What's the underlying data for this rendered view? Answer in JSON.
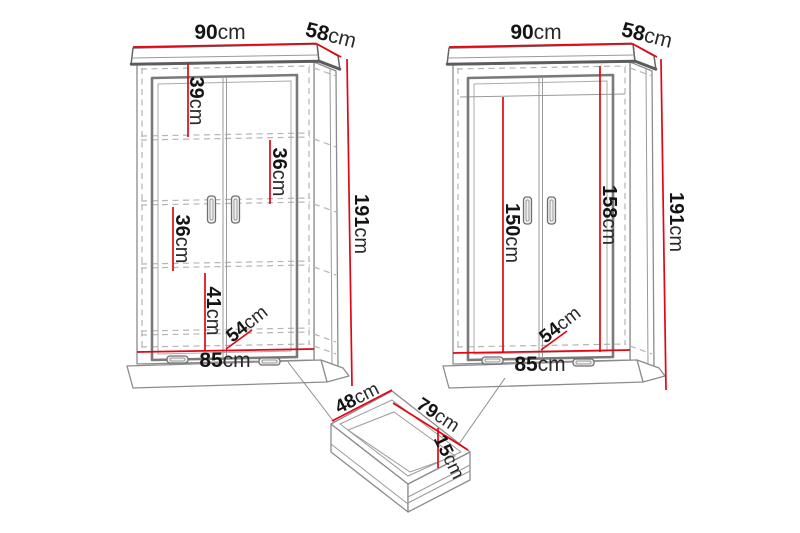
{
  "colors": {
    "dimension_line": "#e30613",
    "outline": "#8c8c8c",
    "outline_dark": "#5c5c5c",
    "dashed_line": "#b5b5b5",
    "label_text": "#141414",
    "background": "#ffffff"
  },
  "left_wardrobe": {
    "width": {
      "num": "90",
      "unit": "cm"
    },
    "depth": {
      "num": "58",
      "unit": "cm"
    },
    "height": {
      "num": "191",
      "unit": "cm"
    },
    "top_section": {
      "num": "39",
      "unit": "cm"
    },
    "upper_shelf_section": {
      "num": "36",
      "unit": "cm"
    },
    "lower_shelf_section": {
      "num": "36",
      "unit": "cm"
    },
    "bottom_section": {
      "num": "41",
      "unit": "cm"
    },
    "interior_depth": {
      "num": "54",
      "unit": "cm"
    },
    "interior_width": {
      "num": "85",
      "unit": "cm"
    }
  },
  "right_wardrobe": {
    "width": {
      "num": "90",
      "unit": "cm"
    },
    "depth": {
      "num": "58",
      "unit": "cm"
    },
    "height": {
      "num": "191",
      "unit": "cm"
    },
    "hanging_height_left": {
      "num": "150",
      "unit": "cm"
    },
    "hanging_height_right": {
      "num": "158",
      "unit": "cm"
    },
    "interior_depth": {
      "num": "54",
      "unit": "cm"
    },
    "interior_width": {
      "num": "85",
      "unit": "cm"
    }
  },
  "drawer": {
    "depth": {
      "num": "48",
      "unit": "cm"
    },
    "width": {
      "num": "79",
      "unit": "cm"
    },
    "height": {
      "num": "15",
      "unit": "cm"
    }
  }
}
